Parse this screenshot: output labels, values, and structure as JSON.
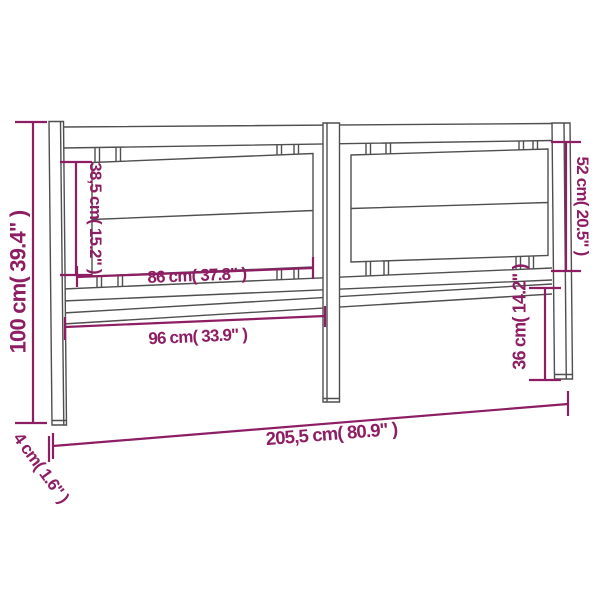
{
  "diagram": {
    "subject": "headboard with dimension annotations",
    "colors": {
      "dimension_accent": "#8E1E63",
      "structure_line": "#4F4F4F",
      "background": "#FFFFFF"
    },
    "dimensions": {
      "overall_height": {
        "text": "100 cm( 39.4\" )",
        "cm": "100",
        "inches": "39.4"
      },
      "left_panel_height": {
        "text": "38,5 cm( 15.2\" )",
        "cm": "38,5",
        "inches": "15.2"
      },
      "right_panel_height": {
        "text": "52 cm( 20.5\" )",
        "cm": "52",
        "inches": "20.5"
      },
      "upper_inner_width": {
        "text": "86 cm( 37.8\" )",
        "cm": "86",
        "inches": "37.8"
      },
      "lower_inner_width": {
        "text": "96 cm( 33.9\" )",
        "cm": "96",
        "inches": "33.9"
      },
      "leg_lower_height": {
        "text": "36 cm( 14.2\" )",
        "cm": "36",
        "inches": "14.2"
      },
      "overall_width": {
        "text": "205,5 cm( 80.9\" )",
        "cm": "205,5",
        "inches": "80.9"
      },
      "board_thickness": {
        "text": "4 cm( 1.6\" )",
        "cm": "4",
        "inches": "1.6"
      }
    }
  }
}
